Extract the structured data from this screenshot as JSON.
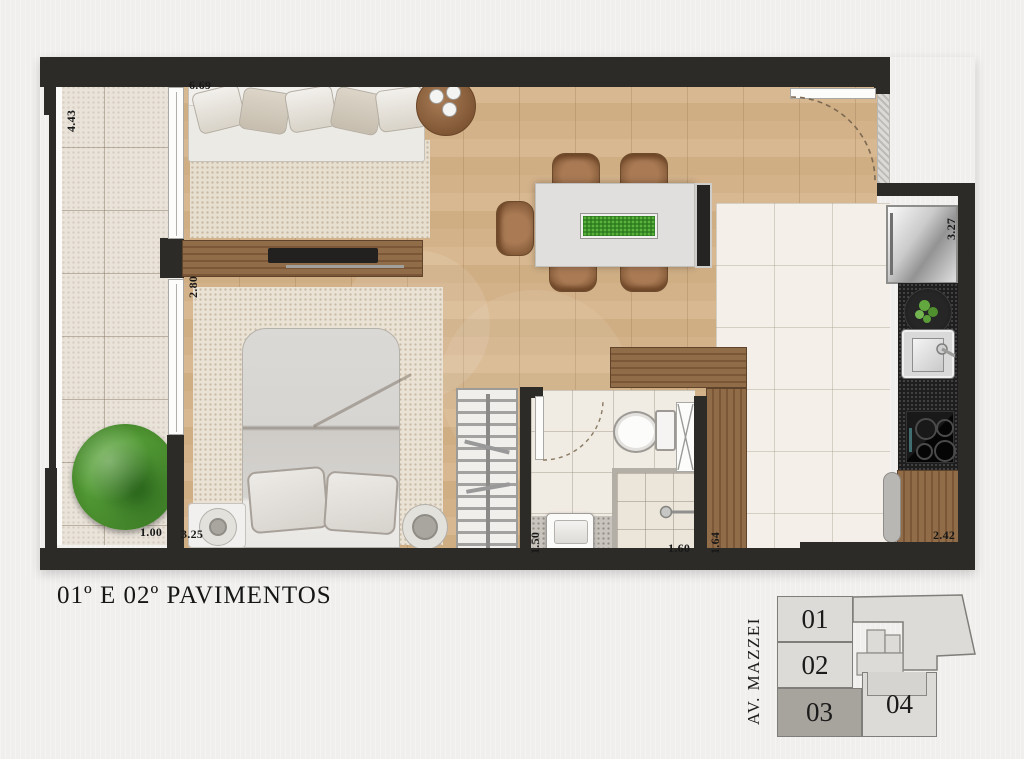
{
  "title": "01º E 02º PAVIMENTOS",
  "dimensions": {
    "balcony_length": "4.43",
    "living_front": "6.69",
    "bedroom_side": "2.80",
    "bedroom_front": "3.25",
    "balcony_width": "1.00",
    "bathroom_width": "1.50",
    "bathroom_length": "1.60",
    "service_side": "1.64",
    "kitchen_front": "2.42",
    "kitchen_side": "3.27"
  },
  "keyplan": {
    "street_label": "AV. MAZZEI",
    "units": [
      {
        "label": "01",
        "highlighted": false
      },
      {
        "label": "02",
        "highlighted": false
      },
      {
        "label": "03",
        "highlighted": true
      },
      {
        "label": "04",
        "highlighted": false
      }
    ]
  },
  "colors": {
    "wall": "#2d2b28",
    "wood_floor": "#d2b189",
    "furniture_wood": "#8a6446",
    "tile_light": "#f3efe8",
    "granite": "#1e1e1e",
    "plant_green": "#4f9136",
    "keyplan_highlight": "#a7a39d",
    "background": "#f0efed"
  }
}
